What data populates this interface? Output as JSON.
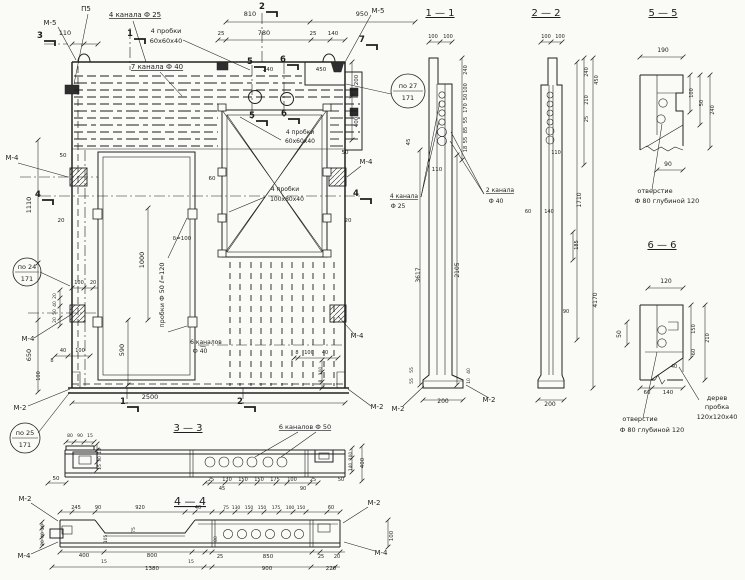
{
  "meta": {
    "type": "scanned engineering drawing",
    "language": "ru",
    "content": "precast concrete ventilation wall panel: elevation, sections 1-1, 2-2, 3-3, 4-4, details 5-5, 6-6"
  },
  "colors": {
    "paper": "#fafaf7",
    "ink": "#1e1e1e"
  },
  "labels": [
    {
      "n": "note-m5-top-left",
      "t": "М-5",
      "x": 50,
      "y": 25,
      "s": 7
    },
    {
      "n": "note-p5",
      "t": "П5",
      "x": 86,
      "y": 11,
      "s": 7
    },
    {
      "n": "note-4-kanala-f25",
      "t": "4 канала Ф 25",
      "x": 135,
      "y": 17,
      "s": 7,
      "u": 1
    },
    {
      "n": "dim",
      "t": "110",
      "x": 65,
      "y": 35
    },
    {
      "n": "dim",
      "t": "810",
      "x": 250,
      "y": 16
    },
    {
      "n": "dim",
      "t": "950",
      "x": 362,
      "y": 16
    },
    {
      "n": "dim",
      "t": "25",
      "x": 221,
      "y": 35,
      "s": 5.5
    },
    {
      "n": "dim",
      "t": "780",
      "x": 264,
      "y": 35
    },
    {
      "n": "dim",
      "t": "25",
      "x": 313,
      "y": 35,
      "s": 5.5
    },
    {
      "n": "dim",
      "t": "140",
      "x": 333,
      "y": 35,
      "s": 5.5
    },
    {
      "n": "note-4-probki-60-1",
      "t": "4 пробки",
      "x": 166,
      "y": 33,
      "s": 6.5
    },
    {
      "n": "note-4-probki-60-1b",
      "t": "60х60х40",
      "x": 166,
      "y": 43,
      "s": 6.5
    },
    {
      "n": "note-7-kanala-f40",
      "t": "7 канала Ф 40",
      "x": 157,
      "y": 69,
      "s": 7,
      "u": 1
    },
    {
      "n": "note-m5-top-right",
      "t": "М-5",
      "x": 378,
      "y": 13,
      "s": 7
    },
    {
      "n": "dim",
      "t": "240",
      "x": 268,
      "y": 71,
      "s": 5.5
    },
    {
      "n": "dim",
      "t": "450",
      "x": 321,
      "y": 71,
      "s": 5.5
    },
    {
      "n": "dim",
      "t": "200",
      "x": 358,
      "y": 80,
      "r": -90,
      "s": 5.5
    },
    {
      "n": "dim",
      "t": "400",
      "x": 358,
      "y": 122,
      "r": -90,
      "s": 5.5
    },
    {
      "n": "dim",
      "t": "50",
      "x": 345,
      "y": 154,
      "s": 5.5
    },
    {
      "n": "note-m4-right-1",
      "t": "М-4",
      "x": 366,
      "y": 164,
      "s": 7
    },
    {
      "n": "note-m4-left-1",
      "t": "М-4",
      "x": 12,
      "y": 160,
      "s": 7
    },
    {
      "n": "dim",
      "t": "50",
      "x": 63,
      "y": 157,
      "s": 5.5
    },
    {
      "n": "dim",
      "t": "20",
      "x": 61,
      "y": 222,
      "s": 5.5
    },
    {
      "n": "dim",
      "t": "1110",
      "x": 31,
      "y": 205,
      "r": -90
    },
    {
      "n": "dim",
      "t": "650",
      "x": 31,
      "y": 355,
      "r": -90
    },
    {
      "n": "dim",
      "t": "100",
      "x": 79,
      "y": 284,
      "s": 5
    },
    {
      "n": "dim",
      "t": "20",
      "x": 93,
      "y": 284,
      "s": 5
    },
    {
      "n": "dim",
      "t": "20",
      "x": 56,
      "y": 296,
      "r": -90,
      "s": 4.5
    },
    {
      "n": "dim",
      "t": "40",
      "x": 56,
      "y": 304,
      "r": -90,
      "s": 4.5
    },
    {
      "n": "dim",
      "t": "50",
      "x": 56,
      "y": 312,
      "r": -90,
      "s": 4.5
    },
    {
      "n": "dim",
      "t": "20",
      "x": 56,
      "y": 320,
      "r": -90,
      "s": 4.5
    },
    {
      "n": "note-m4-left-2",
      "t": "М-4",
      "x": 28,
      "y": 341,
      "s": 7
    },
    {
      "n": "dim",
      "t": "40",
      "x": 63,
      "y": 352,
      "s": 5
    },
    {
      "n": "dim",
      "t": "100",
      "x": 80,
      "y": 352,
      "s": 5
    },
    {
      "n": "dim",
      "t": "8",
      "x": 52,
      "y": 362,
      "s": 5
    },
    {
      "n": "dim",
      "t": "100",
      "x": 40,
      "y": 376,
      "r": -90,
      "s": 5
    },
    {
      "n": "note-m2-bottom-left",
      "t": "М-2",
      "x": 20,
      "y": 410,
      "s": 7
    },
    {
      "n": "dim",
      "t": "1000",
      "x": 144,
      "y": 260,
      "r": -90
    },
    {
      "n": "dim",
      "t": "590",
      "x": 124,
      "y": 350,
      "r": -90
    },
    {
      "n": "note-probki-f50",
      "t": "пробки Ф 50  ℓ=120",
      "x": 164,
      "y": 295,
      "r": -90,
      "s": 6.5
    },
    {
      "n": "note-delta-100",
      "t": "δ=100",
      "x": 182,
      "y": 240,
      "s": 5.5
    },
    {
      "n": "dim",
      "t": "60",
      "x": 212,
      "y": 180,
      "s": 5.5
    },
    {
      "n": "note-4-probki-60-2",
      "t": "4 пробки",
      "x": 300,
      "y": 134,
      "s": 6
    },
    {
      "n": "note-4-probki-60-2b",
      "t": "60х60х40",
      "x": 300,
      "y": 143,
      "s": 6
    },
    {
      "n": "note-4-probki-100",
      "t": "4 пробки",
      "x": 285,
      "y": 191,
      "s": 6
    },
    {
      "n": "note-4-probki-100b",
      "t": "100х80х40",
      "x": 287,
      "y": 201,
      "s": 6
    },
    {
      "n": "dim",
      "t": "20",
      "x": 348,
      "y": 222,
      "s": 5.5
    },
    {
      "n": "note-m4-right-2",
      "t": "М-4",
      "x": 357,
      "y": 338,
      "s": 7
    },
    {
      "n": "dim",
      "t": "8",
      "x": 297,
      "y": 354,
      "s": 5
    },
    {
      "n": "dim",
      "t": "100",
      "x": 309,
      "y": 354,
      "s": 5
    },
    {
      "n": "dim",
      "t": "40",
      "x": 325,
      "y": 354,
      "s": 5
    },
    {
      "n": "dim",
      "t": "100",
      "x": 322,
      "y": 371,
      "r": -90,
      "s": 4.5
    },
    {
      "n": "dim",
      "t": "8",
      "x": 322,
      "y": 381,
      "r": -90,
      "s": 4.5
    },
    {
      "n": "dim",
      "t": "2500",
      "x": 150,
      "y": 399
    },
    {
      "n": "note-6-kanalov-f40",
      "t": "6 каналов",
      "x": 206,
      "y": 344,
      "s": 6
    },
    {
      "n": "note-6-kanalov-f40b",
      "t": "Ф 40",
      "x": 200,
      "y": 353,
      "s": 6
    },
    {
      "n": "note-m2-bottom-right",
      "t": "М-2",
      "x": 377,
      "y": 409,
      "s": 7
    },
    {
      "n": "section-title-1-1",
      "t": "1 — 1",
      "x": 440,
      "y": 16,
      "s": 10,
      "u": 1
    },
    {
      "n": "dim",
      "t": "100",
      "x": 433,
      "y": 38,
      "s": 5
    },
    {
      "n": "dim",
      "t": "100",
      "x": 448,
      "y": 38,
      "s": 5
    },
    {
      "n": "dim",
      "t": "240",
      "x": 467,
      "y": 70,
      "r": -90,
      "s": 5
    },
    {
      "n": "dim",
      "t": "100",
      "x": 467,
      "y": 88,
      "r": -90,
      "s": 5
    },
    {
      "n": "dim",
      "t": "50",
      "x": 467,
      "y": 97,
      "r": -90,
      "s": 5
    },
    {
      "n": "dim",
      "t": "170",
      "x": 467,
      "y": 108,
      "r": -90,
      "s": 5
    },
    {
      "n": "dim",
      "t": "55",
      "x": 467,
      "y": 120,
      "r": -90,
      "s": 5
    },
    {
      "n": "dim",
      "t": "85",
      "x": 467,
      "y": 130,
      "r": -90,
      "s": 5
    },
    {
      "n": "dim",
      "t": "55",
      "x": 467,
      "y": 140,
      "r": -90,
      "s": 5
    },
    {
      "n": "dim",
      "t": "18",
      "x": 467,
      "y": 149,
      "r": -90,
      "s": 5
    },
    {
      "n": "dim",
      "t": "45",
      "x": 410,
      "y": 142,
      "r": -90,
      "s": 5.5
    },
    {
      "n": "dim",
      "t": "110",
      "x": 437,
      "y": 171,
      "s": 5.5
    },
    {
      "n": "note-4-kanala-f25-s1",
      "t": "4 канала",
      "x": 404,
      "y": 198,
      "s": 6,
      "u": 1
    },
    {
      "n": "note-4-kanala-f25-s1b",
      "t": "Ф 25",
      "x": 398,
      "y": 208,
      "s": 6
    },
    {
      "n": "note-2-kanala-f40-s1",
      "t": "2 канала",
      "x": 500,
      "y": 192,
      "s": 6,
      "u": 1
    },
    {
      "n": "note-2-kanala-f40-s1b",
      "t": "Ф 40",
      "x": 496,
      "y": 203,
      "s": 6
    },
    {
      "n": "dim",
      "t": "3617",
      "x": 420,
      "y": 275,
      "r": -90,
      "s": 6
    },
    {
      "n": "dim",
      "t": "2105",
      "x": 459,
      "y": 270,
      "r": -90,
      "s": 6
    },
    {
      "n": "dim",
      "t": "55",
      "x": 413,
      "y": 370,
      "r": -90,
      "s": 4.5
    },
    {
      "n": "dim",
      "t": "55",
      "x": 413,
      "y": 381,
      "r": -90,
      "s": 4.5
    },
    {
      "n": "dim",
      "t": "40",
      "x": 470,
      "y": 371,
      "r": -90,
      "s": 4.5
    },
    {
      "n": "dim",
      "t": "10",
      "x": 470,
      "y": 381,
      "r": -90,
      "s": 4.5
    },
    {
      "n": "dim",
      "t": "200",
      "x": 443,
      "y": 403,
      "s": 6
    },
    {
      "n": "note-m2-s1-left",
      "t": "М-2",
      "x": 398,
      "y": 411,
      "s": 7
    },
    {
      "n": "note-m2-s1-right",
      "t": "М-2",
      "x": 489,
      "y": 402,
      "s": 7
    },
    {
      "n": "section-title-2-2",
      "t": "2 — 2",
      "x": 546,
      "y": 16,
      "s": 10,
      "u": 1
    },
    {
      "n": "dim",
      "t": "100",
      "x": 546,
      "y": 38,
      "s": 5
    },
    {
      "n": "dim",
      "t": "100",
      "x": 560,
      "y": 38,
      "s": 5
    },
    {
      "n": "dim",
      "t": "240",
      "x": 588,
      "y": 72,
      "r": -90,
      "s": 5
    },
    {
      "n": "dim",
      "t": "450",
      "x": 598,
      "y": 80,
      "r": -90,
      "s": 5
    },
    {
      "n": "dim",
      "t": "210",
      "x": 588,
      "y": 100,
      "r": -90,
      "s": 5
    },
    {
      "n": "dim",
      "t": "25",
      "x": 588,
      "y": 119,
      "r": -90,
      "s": 5
    },
    {
      "n": "dim",
      "t": "110",
      "x": 556,
      "y": 154,
      "s": 5
    },
    {
      "n": "dim",
      "t": "1710",
      "x": 581,
      "y": 200,
      "r": -90,
      "s": 6
    },
    {
      "n": "dim",
      "t": "4170",
      "x": 597,
      "y": 300,
      "r": -90,
      "s": 6
    },
    {
      "n": "dim",
      "t": "60",
      "x": 528,
      "y": 213,
      "s": 5
    },
    {
      "n": "dim",
      "t": "140",
      "x": 549,
      "y": 213,
      "s": 5
    },
    {
      "n": "dim",
      "t": "185",
      "x": 578,
      "y": 245,
      "r": -90,
      "s": 5
    },
    {
      "n": "dim",
      "t": "90",
      "x": 566,
      "y": 313,
      "s": 5
    },
    {
      "n": "dim",
      "t": "200",
      "x": 550,
      "y": 406,
      "s": 6
    },
    {
      "n": "section-title-5-5",
      "t": "5 — 5",
      "x": 663,
      "y": 16,
      "s": 10,
      "u": 1
    },
    {
      "n": "dim",
      "t": "190",
      "x": 663,
      "y": 52,
      "s": 6
    },
    {
      "n": "dim",
      "t": "100",
      "x": 693,
      "y": 93,
      "r": -90,
      "s": 5
    },
    {
      "n": "dim",
      "t": "50",
      "x": 703,
      "y": 103,
      "r": -90,
      "s": 5
    },
    {
      "n": "dim",
      "t": "240",
      "x": 714,
      "y": 110,
      "r": -90,
      "s": 5
    },
    {
      "n": "dim",
      "t": "90",
      "x": 668,
      "y": 166,
      "s": 6
    },
    {
      "n": "note-otverstie-5-5",
      "t": "отверстие",
      "x": 655,
      "y": 193,
      "s": 6.5
    },
    {
      "n": "note-otverstie-5-5b",
      "t": "Ф 80 глубиной 120",
      "x": 667,
      "y": 203,
      "s": 6.5
    },
    {
      "n": "section-title-6-6",
      "t": "6 — 6",
      "x": 662,
      "y": 248,
      "s": 10,
      "u": 1
    },
    {
      "n": "dim",
      "t": "120",
      "x": 666,
      "y": 283,
      "s": 6
    },
    {
      "n": "dim",
      "t": "50",
      "x": 621,
      "y": 334,
      "r": -90,
      "s": 6
    },
    {
      "n": "dim",
      "t": "150",
      "x": 695,
      "y": 329,
      "r": -90,
      "s": 5
    },
    {
      "n": "dim",
      "t": "60",
      "x": 695,
      "y": 352,
      "r": -90,
      "s": 5
    },
    {
      "n": "dim",
      "t": "210",
      "x": 709,
      "y": 338,
      "r": -90,
      "s": 5
    },
    {
      "n": "dim",
      "t": "40",
      "x": 674,
      "y": 368,
      "s": 5
    },
    {
      "n": "dim",
      "t": "60",
      "x": 647,
      "y": 394,
      "s": 5.5
    },
    {
      "n": "dim",
      "t": "140",
      "x": 668,
      "y": 394,
      "s": 5.5
    },
    {
      "n": "note-derev-probka",
      "t": "дерев",
      "x": 717,
      "y": 400,
      "s": 6.5
    },
    {
      "n": "note-derev-probka-b",
      "t": "пробка",
      "x": 717,
      "y": 409,
      "s": 6.5
    },
    {
      "n": "note-derev-probka-c",
      "t": "120х120х40",
      "x": 717,
      "y": 419,
      "s": 6.5
    },
    {
      "n": "note-otverstie-6-6",
      "t": "отверстие",
      "x": 640,
      "y": 421,
      "s": 6.5
    },
    {
      "n": "note-otverstie-6-6b",
      "t": "Ф 80 глубиной 120",
      "x": 652,
      "y": 432,
      "s": 6.5
    },
    {
      "n": "section-title-3-3",
      "t": "3 — 3",
      "x": 188,
      "y": 431,
      "s": 10,
      "u": 1
    },
    {
      "n": "note-6-kanalov-f50",
      "t": "6 каналов Ф 50",
      "x": 305,
      "y": 429,
      "s": 6.5,
      "u": 1
    },
    {
      "n": "dim",
      "t": "80",
      "x": 70,
      "y": 437,
      "s": 4.5
    },
    {
      "n": "dim",
      "t": "90",
      "x": 80,
      "y": 437,
      "s": 4.5
    },
    {
      "n": "dim",
      "t": "15",
      "x": 90,
      "y": 437,
      "s": 4.5
    },
    {
      "n": "dim",
      "t": "15",
      "x": 101,
      "y": 451,
      "r": -90,
      "s": 4.5
    },
    {
      "n": "dim",
      "t": "30",
      "x": 101,
      "y": 459,
      "r": -90,
      "s": 4.5
    },
    {
      "n": "dim",
      "t": "15",
      "x": 101,
      "y": 467,
      "r": -90,
      "s": 4.5
    },
    {
      "n": "dim",
      "t": "50",
      "x": 56,
      "y": 480,
      "s": 5.5
    },
    {
      "n": "dim",
      "t": "25",
      "x": 211,
      "y": 481,
      "s": 5
    },
    {
      "n": "dim",
      "t": "130",
      "x": 227,
      "y": 481,
      "s": 5
    },
    {
      "n": "dim",
      "t": "150",
      "x": 243,
      "y": 481,
      "s": 5
    },
    {
      "n": "dim",
      "t": "150",
      "x": 259,
      "y": 481,
      "s": 5
    },
    {
      "n": "dim",
      "t": "175",
      "x": 275,
      "y": 481,
      "s": 5
    },
    {
      "n": "dim",
      "t": "100",
      "x": 292,
      "y": 481,
      "s": 5
    },
    {
      "n": "dim",
      "t": "25",
      "x": 313,
      "y": 481,
      "s": 5
    },
    {
      "n": "dim",
      "t": "45",
      "x": 222,
      "y": 490,
      "s": 5
    },
    {
      "n": "dim",
      "t": "90",
      "x": 303,
      "y": 490,
      "s": 5
    },
    {
      "n": "dim",
      "t": "50",
      "x": 341,
      "y": 481,
      "s": 5
    },
    {
      "n": "dim",
      "t": "100",
      "x": 352,
      "y": 456,
      "r": -90,
      "s": 4.5
    },
    {
      "n": "dim",
      "t": "140",
      "x": 352,
      "y": 467,
      "r": -90,
      "s": 4.5
    },
    {
      "n": "dim",
      "t": "400",
      "x": 364,
      "y": 463,
      "r": -90,
      "s": 5.5
    },
    {
      "n": "section-title-4-4",
      "t": "4 — 4",
      "x": 190,
      "y": 505,
      "s": 11,
      "u": 1
    },
    {
      "n": "note-m2-s4-tl",
      "t": "М-2",
      "x": 25,
      "y": 501,
      "s": 7
    },
    {
      "n": "note-m4-s4-bl",
      "t": "М-4",
      "x": 24,
      "y": 558,
      "s": 7
    },
    {
      "n": "dim",
      "t": "245",
      "x": 76,
      "y": 509,
      "s": 5
    },
    {
      "n": "dim",
      "t": "90",
      "x": 98,
      "y": 509,
      "s": 5
    },
    {
      "n": "dim",
      "t": "920",
      "x": 140,
      "y": 509,
      "s": 5
    },
    {
      "n": "dim",
      "t": "40",
      "x": 198,
      "y": 509,
      "s": 5
    },
    {
      "n": "dim",
      "t": "75",
      "x": 226,
      "y": 509,
      "s": 4.5
    },
    {
      "n": "dim",
      "t": "130",
      "x": 236,
      "y": 509,
      "s": 4.5
    },
    {
      "n": "dim",
      "t": "150",
      "x": 249,
      "y": 509,
      "s": 4.5
    },
    {
      "n": "dim",
      "t": "150",
      "x": 262,
      "y": 509,
      "s": 4.5
    },
    {
      "n": "dim",
      "t": "175",
      "x": 276,
      "y": 509,
      "s": 4.5
    },
    {
      "n": "dim",
      "t": "100",
      "x": 290,
      "y": 509,
      "s": 4.5
    },
    {
      "n": "dim",
      "t": "150",
      "x": 301,
      "y": 509,
      "s": 4.5
    },
    {
      "n": "dim",
      "t": "60",
      "x": 331,
      "y": 509,
      "s": 5
    },
    {
      "n": "dim",
      "t": "20",
      "x": 44,
      "y": 527,
      "r": -90,
      "s": 4.5
    },
    {
      "n": "dim",
      "t": "40",
      "x": 44,
      "y": 535,
      "r": -90,
      "s": 4.5
    },
    {
      "n": "dim",
      "t": "20",
      "x": 44,
      "y": 543,
      "r": -90,
      "s": 4.5
    },
    {
      "n": "dim",
      "t": "105",
      "x": 107,
      "y": 539,
      "r": -90,
      "s": 4.5
    },
    {
      "n": "dim",
      "t": "75",
      "x": 135,
      "y": 530,
      "r": -90,
      "s": 4.5
    },
    {
      "n": "dim",
      "t": "80",
      "x": 217,
      "y": 539,
      "r": -90,
      "s": 4.5
    },
    {
      "n": "dim",
      "t": "400",
      "x": 84,
      "y": 557,
      "s": 5.5
    },
    {
      "n": "dim",
      "t": "15",
      "x": 104,
      "y": 563,
      "s": 4.5
    },
    {
      "n": "dim",
      "t": "800",
      "x": 152,
      "y": 557,
      "s": 5.5
    },
    {
      "n": "dim",
      "t": "15",
      "x": 191,
      "y": 563,
      "s": 4.5
    },
    {
      "n": "dim",
      "t": "1380",
      "x": 152,
      "y": 570,
      "s": 5.5
    },
    {
      "n": "dim",
      "t": "25",
      "x": 220,
      "y": 558,
      "s": 5
    },
    {
      "n": "dim",
      "t": "850",
      "x": 268,
      "y": 558,
      "s": 5.5
    },
    {
      "n": "dim",
      "t": "25",
      "x": 321,
      "y": 558,
      "s": 5
    },
    {
      "n": "dim",
      "t": "20",
      "x": 337,
      "y": 558,
      "s": 5
    },
    {
      "n": "dim",
      "t": "900",
      "x": 267,
      "y": 570,
      "s": 5.5
    },
    {
      "n": "dim",
      "t": "220",
      "x": 331,
      "y": 570,
      "s": 5.5
    },
    {
      "n": "note-m2-s4-tr",
      "t": "М-2",
      "x": 374,
      "y": 505,
      "s": 7
    },
    {
      "n": "note-m4-s4-br",
      "t": "М-4",
      "x": 381,
      "y": 555,
      "s": 7
    },
    {
      "n": "dim",
      "t": "100",
      "x": 393,
      "y": 536,
      "r": -90,
      "s": 5.5
    }
  ],
  "balloons": [
    {
      "n": "ref-balloon-top",
      "top": "по 27",
      "bottom": "171",
      "x": 408,
      "y": 91,
      "rad": 17
    },
    {
      "n": "ref-balloon-left",
      "top": "по 24",
      "bottom": "171",
      "x": 27,
      "y": 272,
      "rad": 14
    },
    {
      "n": "ref-balloon-bottom-left",
      "top": "по 25",
      "bottom": "171",
      "x": 25,
      "y": 438,
      "rad": 15
    }
  ],
  "markers": [
    {
      "t": "3",
      "x": 40,
      "y": 38
    },
    {
      "t": "1",
      "x": 130,
      "y": 36
    },
    {
      "t": "2",
      "x": 262,
      "y": 9
    },
    {
      "t": "7",
      "x": 362,
      "y": 42
    },
    {
      "t": "5",
      "x": 250,
      "y": 64
    },
    {
      "t": "6",
      "x": 283,
      "y": 62
    },
    {
      "t": "5",
      "x": 252,
      "y": 118
    },
    {
      "t": "6",
      "x": 284,
      "y": 116
    },
    {
      "t": "4",
      "x": 38,
      "y": 197
    },
    {
      "t": "4",
      "x": 356,
      "y": 196
    },
    {
      "t": "1",
      "x": 123,
      "y": 404
    },
    {
      "t": "2",
      "x": 240,
      "y": 404
    }
  ]
}
